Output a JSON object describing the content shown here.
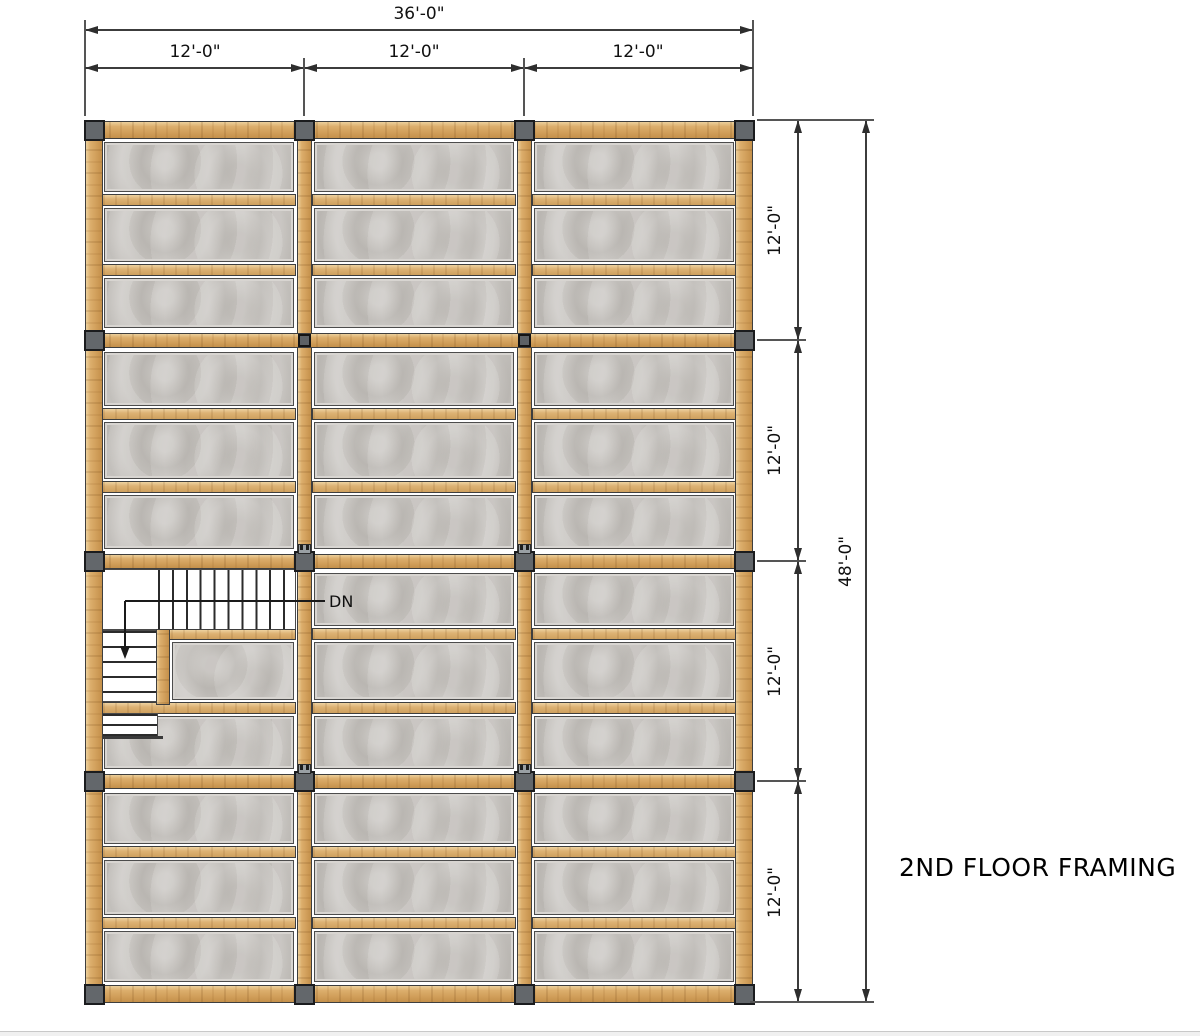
{
  "title": {
    "label": "2ND FLOOR FRAMING"
  },
  "stair_labels": {
    "down": "DN"
  },
  "dimensions": {
    "top_total": "36'-0\"",
    "top_bays": [
      "12'-0\"",
      "12'-0\"",
      "12'-0\""
    ],
    "right_bays": [
      "12'-0\"",
      "12'-0\"",
      "12'-0\"",
      "12'-0\""
    ],
    "right_total": "48'-0\""
  },
  "colors": {
    "wood": "#d5a463",
    "panel": "#c9c6c2",
    "column": "#63676b",
    "line": "#3c3c3c",
    "background": "#ffffff"
  },
  "plan": {
    "total_width_ft": 36,
    "total_height_ft": 48,
    "bay_ft": 12,
    "joist_spacing_ft": 4,
    "left": 85,
    "top": 120,
    "right": 753,
    "bottom": 1003,
    "col_centers": [
      94,
      304,
      524,
      744
    ],
    "row_centers": [
      130,
      340,
      561,
      781,
      994
    ],
    "rim_thickness": 18,
    "beam_thickness": 15,
    "joist_thickness": 12,
    "column_size": 21,
    "small_column_size": 13,
    "stair": {
      "upper_white": {
        "x": 99,
        "y": 569,
        "w": 197,
        "h": 61
      },
      "landing_width": 58,
      "upper_tread_start": 157,
      "upper_tread_step": 13.9,
      "lower_white": {
        "x": 99,
        "y": 630,
        "w": 58,
        "h": 72
      },
      "lower_tread_step": 15,
      "stub_white": {
        "x": 99,
        "y": 713,
        "w": 59,
        "h": 24
      },
      "stub_tread_step": 10,
      "stub_bottom_bar": {
        "x": 99,
        "y": 736,
        "w": 64,
        "h": 3
      },
      "trimmer": {
        "x": 156,
        "y": 629,
        "w": 14,
        "h": 76
      },
      "header_joist": {
        "x": 158,
        "y": 629,
        "w": 138,
        "h": 11
      },
      "walk_h": {
        "x1": 125,
        "x2": 325,
        "y": 601
      },
      "walk_v": {
        "x": 125,
        "y1": 601,
        "y2": 646
      },
      "walk_arrow_tip": {
        "x": 125,
        "y": 658
      }
    }
  }
}
